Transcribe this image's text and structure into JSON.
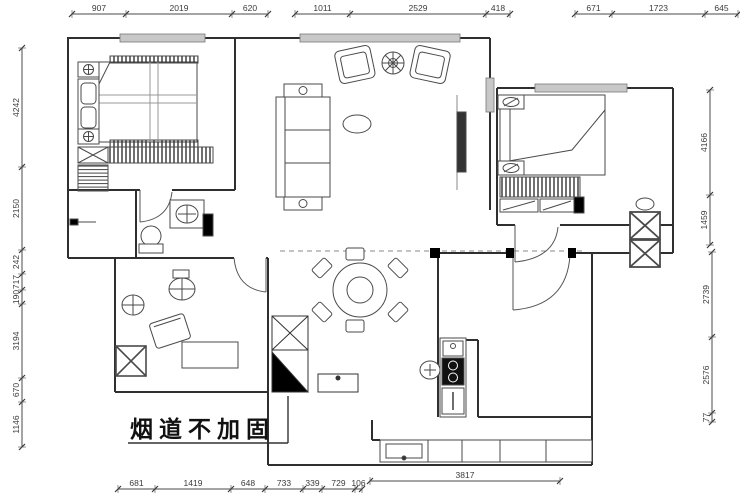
{
  "annotation": {
    "flue_note": "烟道不加固"
  },
  "dimensions": {
    "top": [
      "907",
      "2019",
      "620",
      "1011",
      "2529",
      "418",
      "671",
      "1723",
      "645"
    ],
    "left": [
      "4242",
      "2150",
      "242",
      "717",
      "190",
      "3194",
      "670",
      "1146"
    ],
    "right": [
      "4166",
      "1459",
      "2739",
      "2576",
      "77"
    ],
    "bottom": [
      "681",
      "1419",
      "648",
      "733",
      "339",
      "729",
      "106",
      "3817"
    ]
  },
  "colors": {
    "wall": "#2f2f2f",
    "furniture": "#4a4a4a",
    "dim_line": "#4a4a4a",
    "dim_text": "#3a3a3a",
    "window_fill": "#c8c8c8",
    "solid_black": "#000000",
    "paper": "#ffffff"
  },
  "icons": {
    "dining_table": "round-table-6-chairs",
    "flue_symbol": "black-triangle-duct"
  }
}
